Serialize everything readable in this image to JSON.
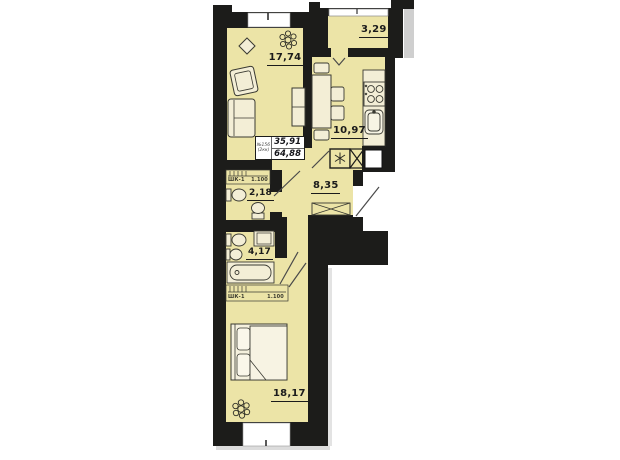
{
  "unit": {
    "number": "№156",
    "type": "(2кк)",
    "living_area": "35,91",
    "total_area": "64,88"
  },
  "rooms": {
    "living": {
      "area": "17,74"
    },
    "balcony": {
      "area": "3,29"
    },
    "kitchen": {
      "area": "10,97"
    },
    "hallway": {
      "area": "8,35"
    },
    "wc": {
      "area": "2,18"
    },
    "bathroom": {
      "area": "4,17"
    },
    "bedroom": {
      "area": "18,17"
    }
  },
  "closets": {
    "top": {
      "label": "ШК-1",
      "dim": "1.100"
    },
    "bottom": {
      "label": "ШК-1",
      "dim": "1.100"
    }
  },
  "colors": {
    "wall": "#1c1c1a",
    "room_fill": "#ece4a7",
    "furniture_fill": "#f3eed6",
    "background": "#ffffff",
    "neighbor_block": "#cfcfcf"
  }
}
